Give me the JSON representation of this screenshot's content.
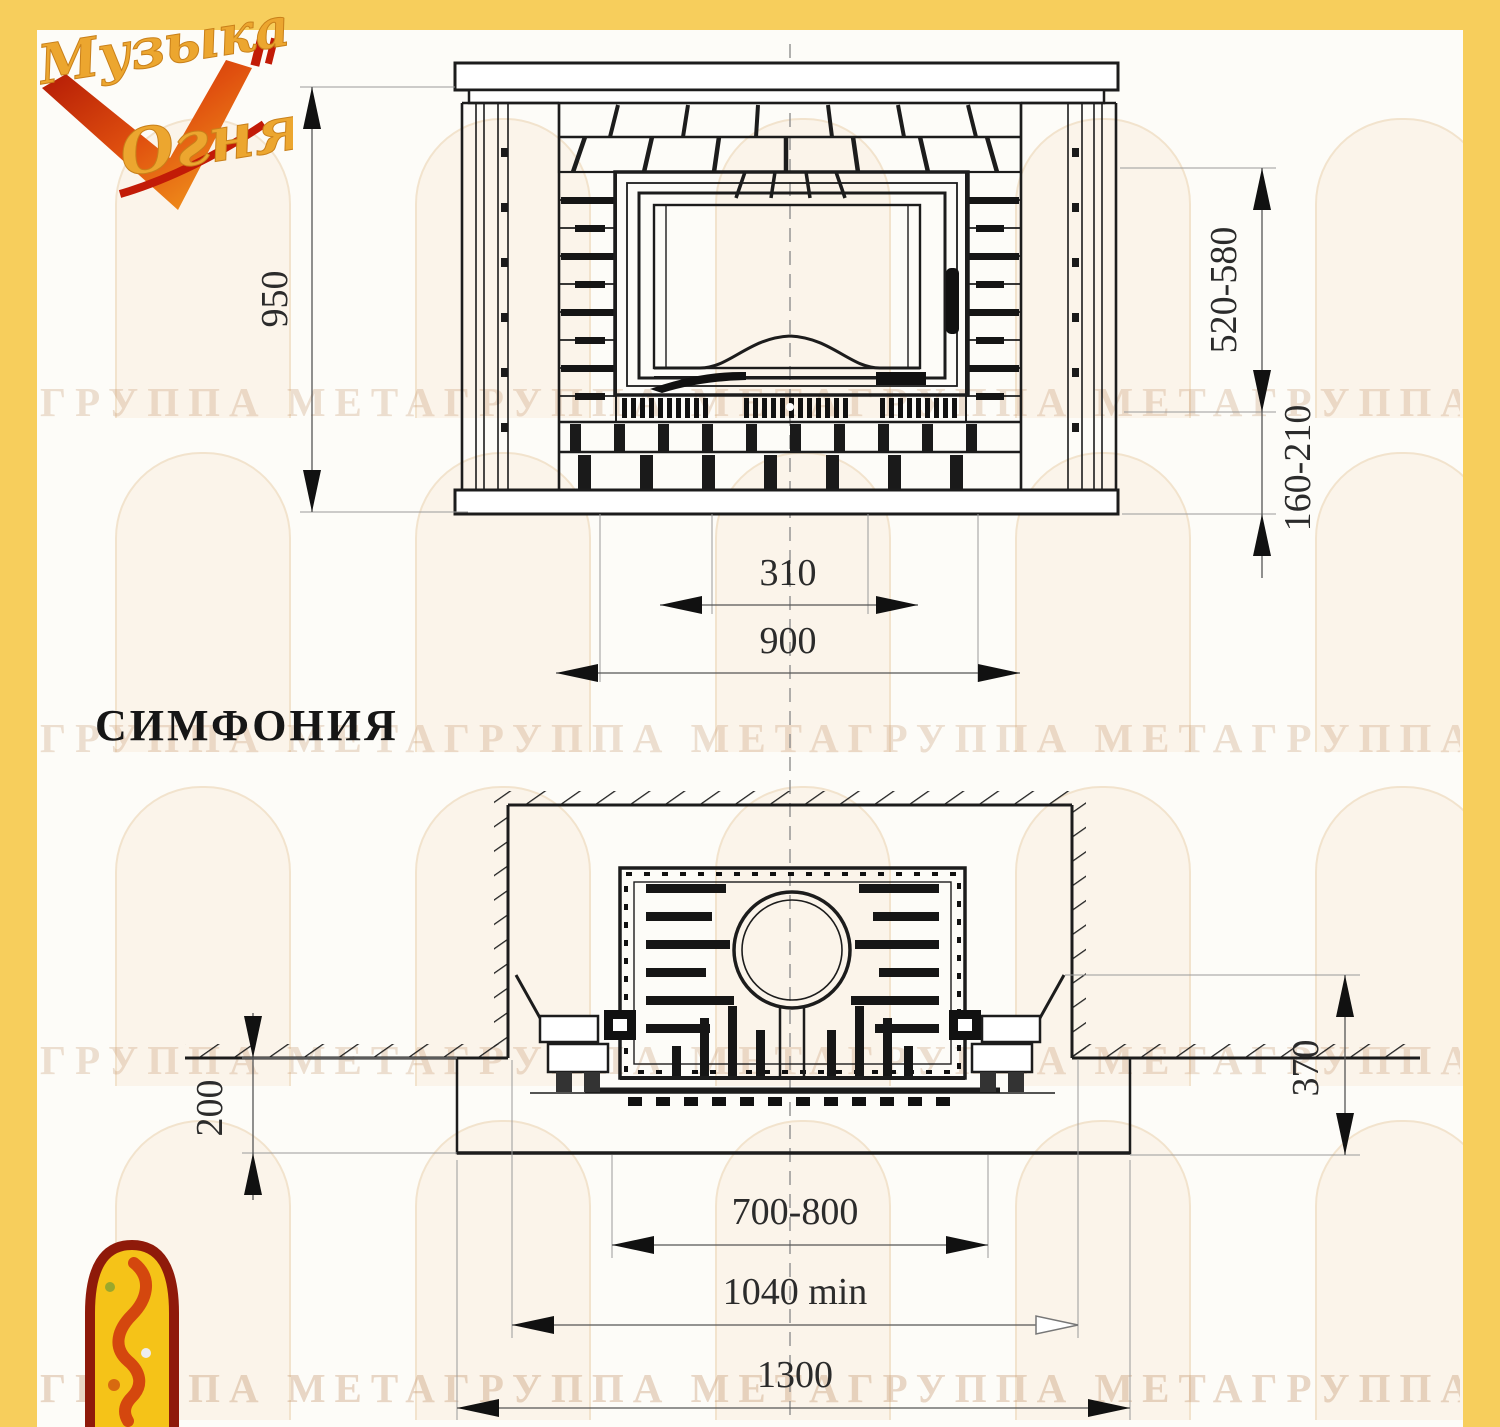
{
  "model": {
    "name": "СИМФОНИЯ"
  },
  "brand": {
    "line1": "Музыка",
    "line2": "Огня"
  },
  "watermark": {
    "text": "ГРУППА МЕТАГРУППА МЕТАГРУППА МЕТАГРУППА МЕТАГРУППА МЕТА"
  },
  "dimensions": {
    "front": {
      "height": "950",
      "opening_height": "520-580",
      "hearth_height": "160-210",
      "grate_width": "310",
      "body_width": "900"
    },
    "plan": {
      "hearth_depth": "200",
      "base_depth": "370",
      "insert_width": "700-800",
      "niche_min_width": "1040 min",
      "base_width": "1300"
    }
  },
  "colors": {
    "accent_yellow": "#F7CE5C",
    "logo_red": "#9E1B0E",
    "logo_orange": "#E0500F",
    "logo_gold": "#ECA62F",
    "line_ink": "#1c1c1c"
  }
}
